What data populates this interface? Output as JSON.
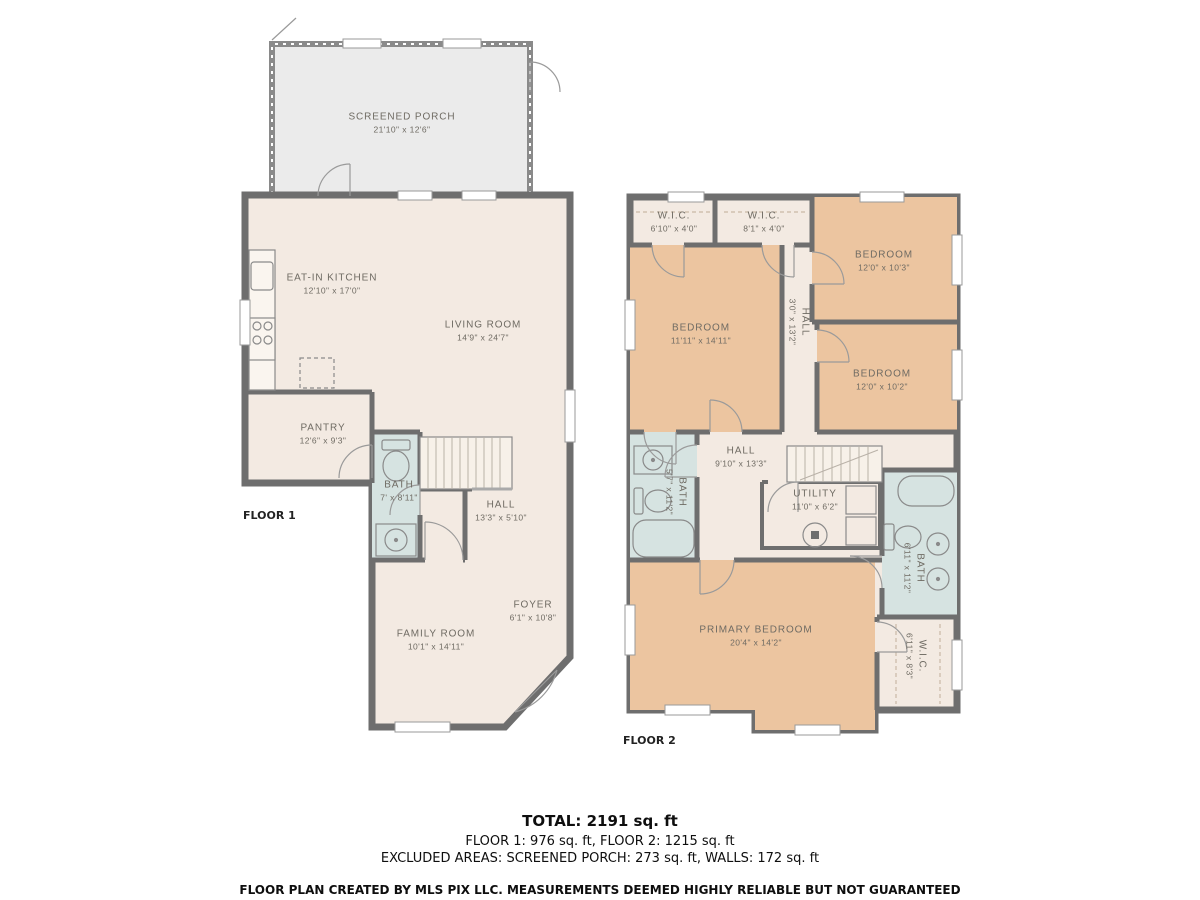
{
  "colors": {
    "wall": "#6e6e6e",
    "room_beige": "#f3eae2",
    "room_tan": "#ecc5a0",
    "room_blue": "#d6e3e1",
    "porch_gray": "#ebebeb",
    "label_text": "#6f6b63"
  },
  "floor1": {
    "label": "FLOOR 1",
    "rooms": [
      {
        "name": "SCREENED PORCH",
        "dims": "21'10\" x 12'6\""
      },
      {
        "name": "EAT-IN KITCHEN",
        "dims": "12'10\" x 17'0\""
      },
      {
        "name": "LIVING ROOM",
        "dims": "14'9\" x 24'7\""
      },
      {
        "name": "PANTRY",
        "dims": "12'6\" x 9'3\""
      },
      {
        "name": "BATH",
        "dims": "7' x 8'11\""
      },
      {
        "name": "HALL",
        "dims": "13'3\" x 5'10\""
      },
      {
        "name": "FOYER",
        "dims": "6'1\" x 10'8\""
      },
      {
        "name": "FAMILY ROOM",
        "dims": "10'1\" x 14'11\""
      }
    ]
  },
  "floor2": {
    "label": "FLOOR 2",
    "rooms": [
      {
        "name": "W.I.C.",
        "dims": "6'10\" x 4'0\""
      },
      {
        "name": "W.I.C.",
        "dims": "8'1\" x 4'0\""
      },
      {
        "name": "BEDROOM",
        "dims": "12'0\" x 10'3\""
      },
      {
        "name": "BEDROOM",
        "dims": "11'11\" x 14'11\""
      },
      {
        "name": "HALL",
        "dims": "3'0\" x 13'2\""
      },
      {
        "name": "BEDROOM",
        "dims": "12'0\" x 10'2\""
      },
      {
        "name": "BATH",
        "dims": "5'7\" x 11'2\""
      },
      {
        "name": "HALL",
        "dims": "9'10\" x 13'3\""
      },
      {
        "name": "UTILITY",
        "dims": "11'0\" x 6'2\""
      },
      {
        "name": "BATH",
        "dims": "6'11\" x 11'2\""
      },
      {
        "name": "PRIMARY BEDROOM",
        "dims": "20'4\" x 14'2\""
      },
      {
        "name": "W.I.C.",
        "dims": "6'11\" x 8'3\""
      }
    ]
  },
  "footer": {
    "total": "TOTAL: 2191 sq. ft",
    "floors": "FLOOR 1: 976 sq. ft, FLOOR 2: 1215 sq. ft",
    "excluded": "EXCLUDED AREAS: SCREENED PORCH: 273 sq. ft, WALLS: 172 sq. ft",
    "disclaimer": "FLOOR PLAN CREATED BY MLS PIX LLC. MEASUREMENTS DEEMED HIGHLY RELIABLE BUT NOT GUARANTEED"
  }
}
